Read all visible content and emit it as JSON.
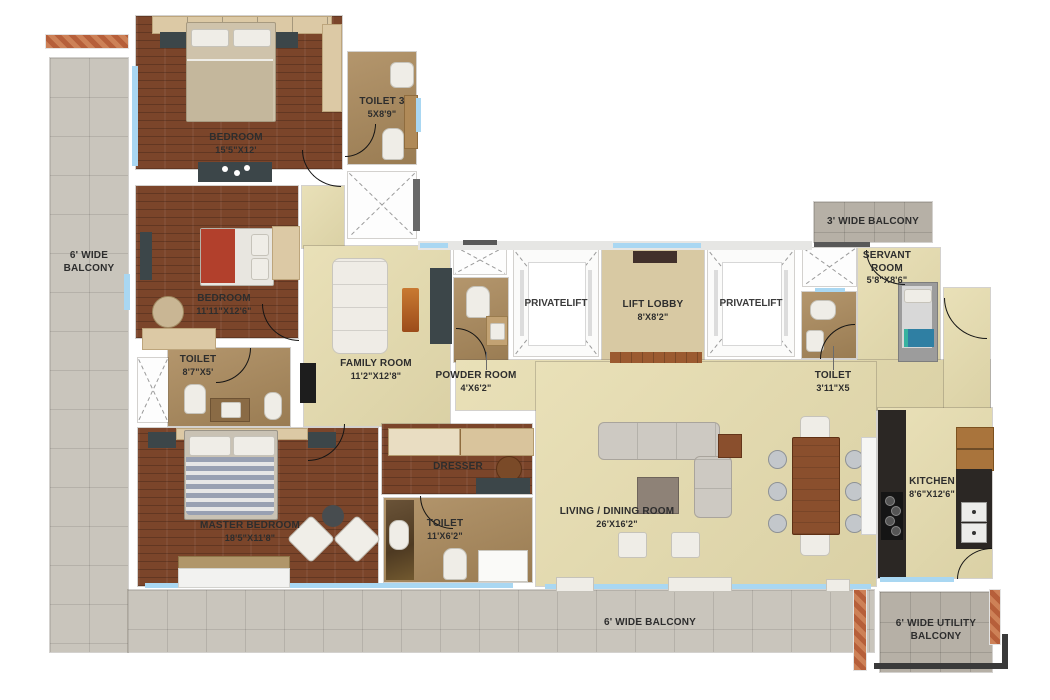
{
  "title": "4 BHK Apartment Floor Plan",
  "colors": {
    "wood": "#7b452a",
    "beige": "#e6dcae",
    "tan": "#ab8a5c",
    "lobby_floor": "#d8c9a3",
    "tile": "#c9c5bc",
    "tile_dark": "#b6b0a6",
    "window_glass": "#a9d7f2",
    "terracotta": "#c27a52",
    "door": "#141414"
  },
  "rooms": {
    "bedroom1": {
      "name": "BEDROOM",
      "size": "15'5\"X12'"
    },
    "toilet3": {
      "name": "TOILET 3",
      "size": "5X8'9\""
    },
    "bedroom2": {
      "name": "BEDROOM",
      "size": "11'11\"X12'6\""
    },
    "toilet2": {
      "name": "TOILET",
      "size": "8'7\"X5'"
    },
    "family": {
      "name": "FAMILY ROOM",
      "size": "11'2\"X12'8\""
    },
    "powder": {
      "name": "POWDER ROOM",
      "size": "4'X6'2\""
    },
    "lift_left": {
      "line1": "PRIVATE",
      "line2": "LIFT"
    },
    "lift_lobby": {
      "name": "LIFT LOBBY",
      "size": "8'X8'2\""
    },
    "lift_right": {
      "line1": "PRIVATE",
      "line2": "LIFT"
    },
    "balcony_top": {
      "name": "3' WIDE BALCONY"
    },
    "servant": {
      "line1": "SERVANT",
      "line2": "ROOM",
      "size": "5'8\"X8'6\""
    },
    "toilet_servant": {
      "name": "TOILET",
      "size": "3'11\"X5"
    },
    "master": {
      "name": "MASTER BEDROOM",
      "size": "18'5\"X11'8\""
    },
    "dresser": {
      "name": "DRESSER"
    },
    "toilet_master": {
      "name": "TOILET",
      "size": "11'X6'2\""
    },
    "living": {
      "name": "LIVING / DINING ROOM",
      "size": "26'X16'2\""
    },
    "kitchen": {
      "name": "KITCHEN",
      "size": "8'6\"X12'6\""
    },
    "balcony_left": {
      "line1": "6' WIDE",
      "line2": "BALCONY"
    },
    "balcony_bottom": {
      "name": "6' WIDE BALCONY"
    },
    "utility_balcony": {
      "line1": "6' WIDE UTILITY",
      "line2": "BALCONY"
    }
  }
}
